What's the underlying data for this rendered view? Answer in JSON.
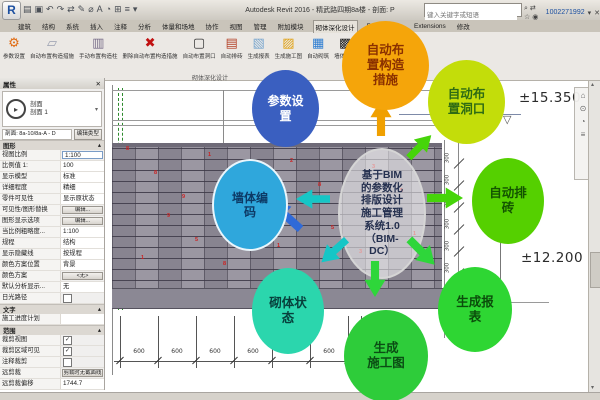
{
  "window": {
    "logo": "R",
    "title": "Autodesk Revit 2016 - 精武路四期8a楼 - 剖面: P",
    "search_placeholder": "键入关键字或短语",
    "account": "1002271992",
    "qat": [
      {
        "name": "open-icon",
        "glyph": "▤"
      },
      {
        "name": "save-icon",
        "glyph": "▣"
      },
      {
        "name": "undo-icon",
        "glyph": "↶"
      },
      {
        "name": "redo-icon",
        "glyph": "↷"
      },
      {
        "name": "print-icon",
        "glyph": "⇄"
      },
      {
        "name": "modify-icon",
        "glyph": "✎"
      },
      {
        "name": "measure-icon",
        "glyph": "⌀"
      },
      {
        "name": "text-icon",
        "glyph": "A"
      },
      {
        "name": "3d-view-icon",
        "glyph": "◔"
      },
      {
        "name": "section-icon",
        "glyph": "⊞"
      },
      {
        "name": "thin-lines-icon",
        "glyph": "≡"
      },
      {
        "name": "customize-icon",
        "glyph": "▾"
      }
    ],
    "tools": [
      {
        "name": "binoculars-icon",
        "glyph": "⌕"
      },
      {
        "name": "sync-icon",
        "glyph": "⇄"
      },
      {
        "name": "star-icon",
        "glyph": "☆"
      },
      {
        "name": "user-icon",
        "glyph": "◉"
      }
    ],
    "dropdown_glyph": "▾",
    "close_glyph": "✕"
  },
  "tabs": [
    {
      "label": "建筑"
    },
    {
      "label": "结构"
    },
    {
      "label": "系统"
    },
    {
      "label": "插入"
    },
    {
      "label": "注释"
    },
    {
      "label": "分析"
    },
    {
      "label": "体量和场地"
    },
    {
      "label": "协作"
    },
    {
      "label": "视图"
    },
    {
      "label": "管理"
    },
    {
      "label": "附加模块"
    },
    {
      "label": "砌体深化设计",
      "active": true
    },
    {
      "label": "Fuzor Plugin"
    },
    {
      "label": "Extensions"
    },
    {
      "label": "修改"
    }
  ],
  "ribbon": {
    "panel_label": "砌体深化设计",
    "buttons": [
      {
        "label": "参数设置",
        "icon": "gear-icon"
      },
      {
        "label": "自动布置构造措施",
        "icon": "panel-icon"
      },
      {
        "label": "手动布置构造柱",
        "icon": "column-icon"
      },
      {
        "label": "删除自动布置构造措施",
        "icon": "delete-icon"
      },
      {
        "label": "自动布置洞口",
        "icon": "opening-icon"
      },
      {
        "label": "自动排砖",
        "icon": "brick-icon"
      },
      {
        "label": "生成报表",
        "icon": "report-icon"
      },
      {
        "label": "生成施工图",
        "icon": "drawing-icon"
      },
      {
        "label": "自动砌筑",
        "icon": "masonry-icon"
      },
      {
        "label": "墙体编码",
        "icon": "code-icon"
      }
    ]
  },
  "properties": {
    "title": "属性",
    "close_glyph": "✕",
    "type_category": "剖面",
    "type_name": "剖面 1",
    "filter": "剖面: 8a-10/8a-A - D",
    "edit_type": "编辑类型",
    "sections": [
      {
        "name": "图形",
        "rows": [
          {
            "label": "视图比例",
            "value": "1:100",
            "type": "input"
          },
          {
            "label": "比例值 1:",
            "value": "100",
            "type": "text"
          },
          {
            "label": "显示模型",
            "value": "标准",
            "type": "text"
          },
          {
            "label": "详细程度",
            "value": "精细",
            "type": "text"
          },
          {
            "label": "零件可见性",
            "value": "显示原状态",
            "type": "text"
          },
          {
            "label": "可见性/图形替换",
            "value": "编辑...",
            "type": "button"
          },
          {
            "label": "图形显示选项",
            "value": "编辑...",
            "type": "button"
          },
          {
            "label": "当比例粗略度...",
            "value": "1:100",
            "type": "text"
          },
          {
            "label": "规程",
            "value": "结构",
            "type": "text"
          },
          {
            "label": "显示隐藏线",
            "value": "按规程",
            "type": "text"
          },
          {
            "label": "颜色方案位置",
            "value": "背景",
            "type": "text"
          },
          {
            "label": "颜色方案",
            "value": "<无>",
            "type": "button"
          },
          {
            "label": "默认分析显示...",
            "value": "无",
            "type": "text"
          },
          {
            "label": "日光路径",
            "value": "",
            "type": "check-off"
          }
        ]
      },
      {
        "name": "文字",
        "rows": [
          {
            "label": "施工进度计划",
            "value": "",
            "type": "text"
          }
        ]
      },
      {
        "name": "范围",
        "rows": [
          {
            "label": "裁剪视图",
            "value": "",
            "type": "check-on"
          },
          {
            "label": "裁剪区域可见",
            "value": "",
            "type": "check-on"
          },
          {
            "label": "注释裁剪",
            "value": "",
            "type": "check-off"
          },
          {
            "label": "远剪裁",
            "value": "剪裁时无截面线",
            "type": "button"
          },
          {
            "label": "远剪裁偏移",
            "value": "1744.7",
            "type": "text"
          },
          {
            "label": "范围框",
            "value": "无",
            "type": "text"
          }
        ]
      },
      {
        "name": "标识数据",
        "rows": []
      }
    ]
  },
  "drawing": {
    "elevation_top": "±15.350",
    "elevation_mid": "±12.200",
    "bottom_dims": [
      "600",
      "600",
      "600",
      "600",
      "600",
      "600",
      "310",
      "309",
      "250",
      "388"
    ],
    "side_dim": "300",
    "side_dim_count": 8,
    "brick_marks": [
      "8",
      "9",
      "1",
      "4",
      "2",
      "5",
      "3",
      "1",
      "8",
      "5",
      "9",
      "1",
      "8",
      "3",
      "5",
      "1",
      "9",
      "8"
    ]
  },
  "diagram": {
    "hub": {
      "label": "基于BIM\n的参数化\n排版设计\n施工管理\n系统1.0\n（BIM-\nDC）",
      "text_color": "#25304f"
    },
    "bubbles": [
      {
        "id": "param",
        "label": "参数设\n置",
        "bg": "#3a5fc0",
        "text_color": "#ffffff"
      },
      {
        "id": "construct",
        "label": "自动布\n置构造\n措施",
        "bg": "#f5a50a",
        "text_color": "#8a3000"
      },
      {
        "id": "opening",
        "label": "自动布\n置洞口",
        "bg": "#c3dd0a",
        "text_color": "#2e6b14"
      },
      {
        "id": "wallcode",
        "label": "墙体编\n码",
        "bg": "#2fa7dc",
        "text_color": "#0d3a66"
      },
      {
        "id": "autobrick",
        "label": "自动排\n砖",
        "bg": "#55d000",
        "text_color": "#135400"
      },
      {
        "id": "status",
        "label": "砌体状\n态",
        "bg": "#2bd6ad",
        "text_color": "#07403c"
      },
      {
        "id": "gendraw",
        "label": "生成\n施工图",
        "bg": "#2ecc3a",
        "text_color": "#0b4d14"
      },
      {
        "id": "genreport",
        "label": "生成报\n表",
        "bg": "#2ed633",
        "text_color": "#0b4d0b"
      }
    ],
    "arrows": [
      {
        "id": "up",
        "color": "#f0a000"
      },
      {
        "id": "upleft",
        "color": "#2f6ad8"
      },
      {
        "id": "upright",
        "color": "#46d40a"
      },
      {
        "id": "left",
        "color": "#16c6c6"
      },
      {
        "id": "right",
        "color": "#46d40a"
      },
      {
        "id": "downleft",
        "color": "#16c6c6"
      },
      {
        "id": "down",
        "color": "#2ed63a"
      },
      {
        "id": "downright",
        "color": "#2ed63a"
      }
    ]
  }
}
